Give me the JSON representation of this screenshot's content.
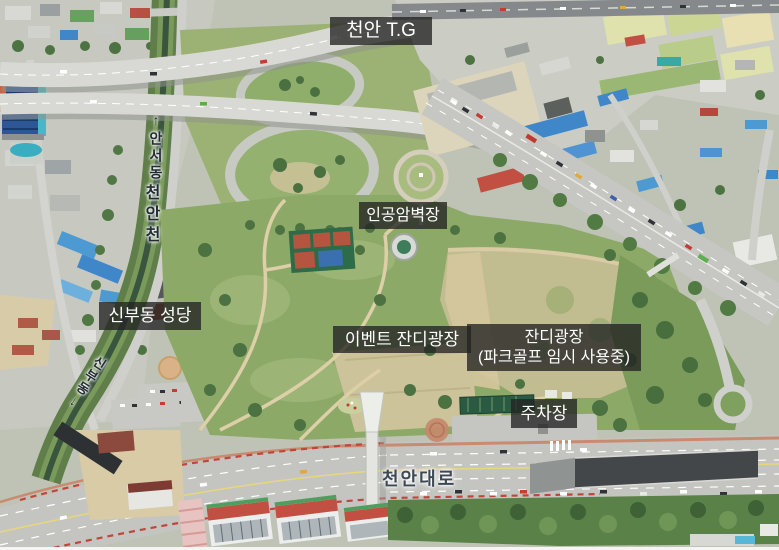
{
  "photo_labels": {
    "toll_gate": "천안 T.G",
    "climbing_wall": "인공암벽장",
    "church": "신부동 성당",
    "event_lawn": "이벤트 잔디광장",
    "lawn_main": "잔디광장",
    "lawn_sub": "(파크골프 임시 사용중)",
    "parking_lot": "주차장",
    "main_road": "천안대로",
    "direction_upstream": "↑안서동",
    "stream_name": "천안천",
    "direction_downstream": "신부동↓"
  },
  "colors": {
    "label_box_bg": "#232323",
    "label_box_text": "#ffffff",
    "road_label_text": "#3d4954",
    "park_green": "#8da968",
    "lawn_tan": "#c2bc91",
    "road_gray": "#c5c6c1"
  }
}
